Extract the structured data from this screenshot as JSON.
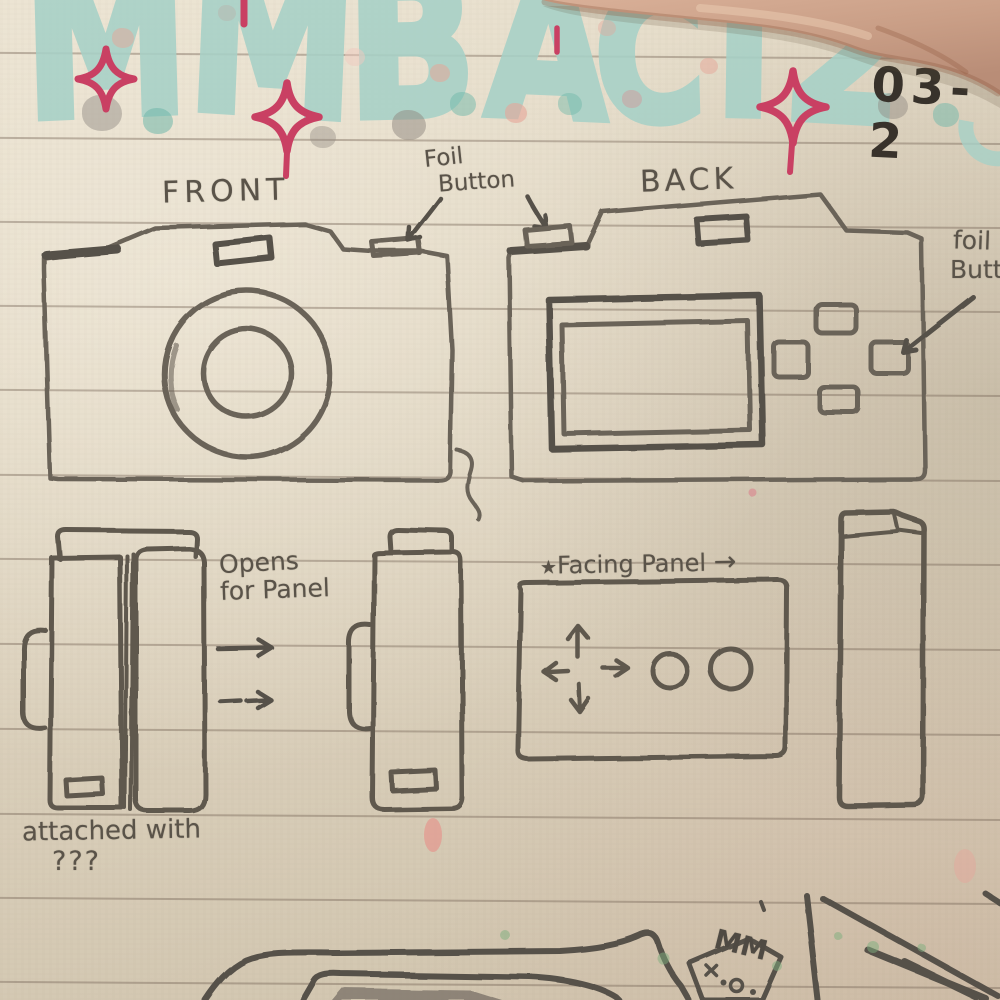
{
  "header": {
    "title": "MMB ACT 2",
    "letters": [
      "M",
      "M",
      "B",
      "A",
      "C",
      "T",
      "2"
    ],
    "date": "03-2"
  },
  "labels": {
    "front": "FRONT",
    "back": "BACK",
    "foil_top_line1": "Foil",
    "foil_top_line2": "Button",
    "foil_right_line1": "foil",
    "foil_right_line2": "Button",
    "opens_line1": "Opens",
    "opens_line2": "for Panel",
    "facing_star": "★",
    "facing": "Facing Panel",
    "facing_arrow": "→",
    "attached_line1": "attached with",
    "attached_line2": "???",
    "mm": "MM"
  },
  "colors": {
    "paper": "#ddd3bf",
    "pencil": "#6b6359",
    "pencil_dark": "#57514a",
    "tape_teal": "#a7d1c7",
    "sparkle_pink": "#c94063",
    "ink": "#38322b",
    "skin": "#c99e86"
  }
}
